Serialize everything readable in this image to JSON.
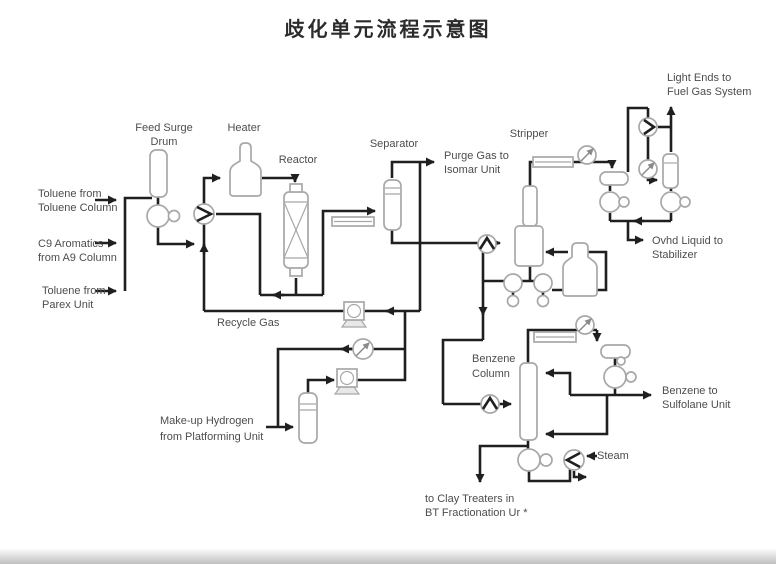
{
  "title": "歧化单元流程示意图",
  "colors": {
    "line": "#1f1f1f",
    "equipment_stroke": "#a8a8a8",
    "text": "#4d4d4d",
    "title_color": "#2b2b2b",
    "background": "#ffffff"
  },
  "labels": {
    "feed_surge_drum": [
      "Feed Surge",
      "Drum"
    ],
    "heater": "Heater",
    "reactor": "Reactor",
    "separator": "Separator",
    "stripper": "Stripper",
    "benzene_column": [
      "Benzene",
      "Column"
    ],
    "recycle_gas": "Recycle Gas",
    "purge_gas": [
      "Purge Gas to",
      "Isomar Unit"
    ],
    "light_ends": [
      "Light Ends to",
      "Fuel Gas System"
    ],
    "ovhd_liquid": [
      "Ovhd Liquid to",
      "Stabilizer"
    ],
    "toluene_from_toluene_column": [
      "Toluene from",
      "Toluene Column"
    ],
    "c9_aromatics": [
      "C9 Aromatics",
      "from A9 Column"
    ],
    "toluene_from_parex": [
      "Toluene from",
      "Parex Unit"
    ],
    "makeup_hydrogen": [
      "Make-up Hydrogen",
      "from Platforming Unit"
    ],
    "benzene_to_sulfolane": [
      "Benzene to",
      "Sulfolane Unit"
    ],
    "steam": "Steam",
    "clay_treaters": [
      "to Clay Treaters in",
      "BT Fractionation Ur *"
    ]
  }
}
